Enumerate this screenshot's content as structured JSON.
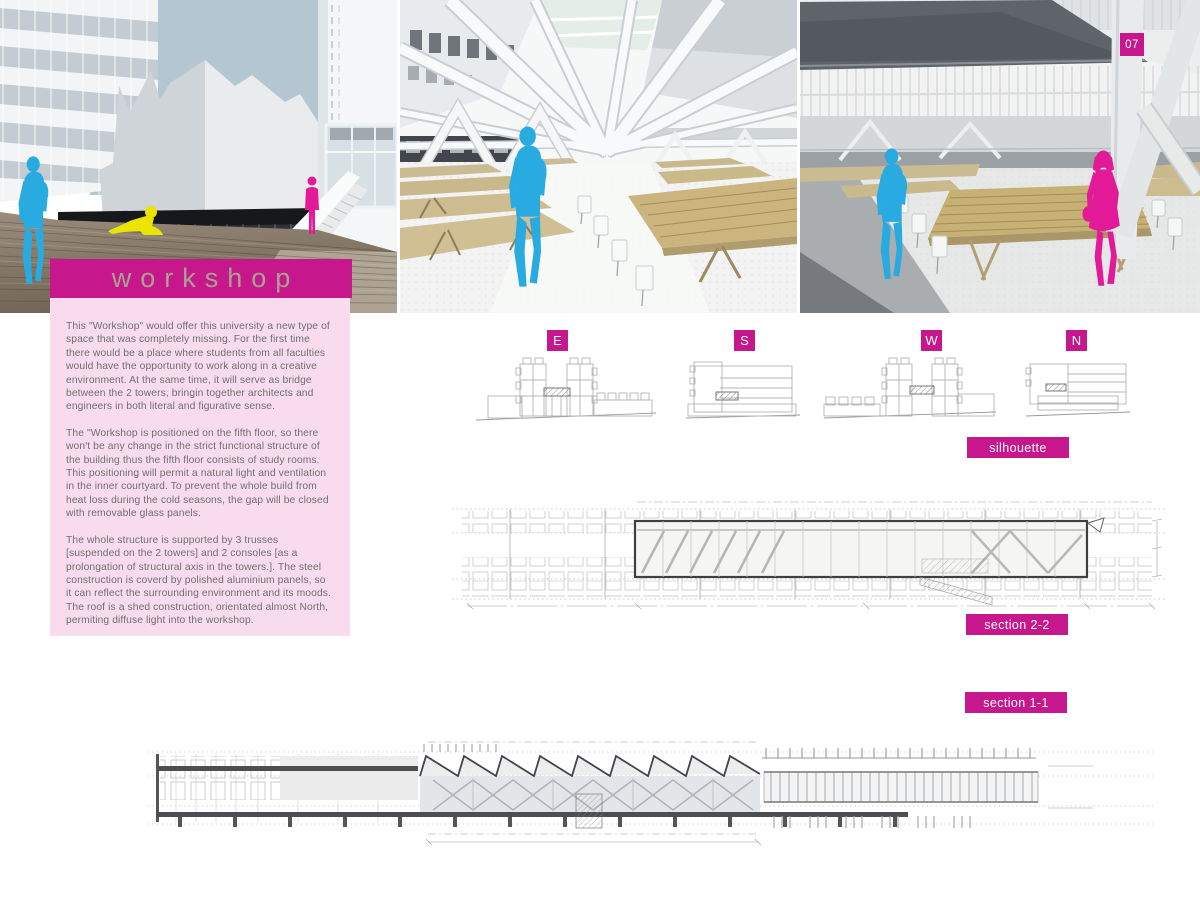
{
  "page": {
    "number": "07"
  },
  "title": {
    "label": "workshop"
  },
  "description": {
    "paragraphs": [
      "This \"Workshop\" would offer this university a new type of space that was completely missing. For the first time there would be a place where students from all faculties would have the opportunity to work along in a creative environment. At the same time, it will serve as bridge between the 2 towers, bringin together architects and engineers in both literal and figurative sense.",
      "The \"Workshop is positioned on the fifth floor, so there won't be any change in the strict functional structure of the building thus the fifth floor consists of study rooms. This positioning will permit a natural light and ventilation in the inner courtyard. To prevent the whole build from heat loss during the cold seasons, the gap will be closed with removable glass panels.",
      "The whole structure is supported by 3 trusses [suspended on the 2 towers] and 2 consoles [as a prolongation of structural axis in the towers.]. The steel construction is coverd by polished aluminium panels, so it can reflect the surrounding environment and its moods. The roof is a shed construction, orientated almost North, permiting diffuse light into the workshop."
    ]
  },
  "elevations": {
    "items": [
      {
        "label": "E"
      },
      {
        "label": "S"
      },
      {
        "label": "W"
      },
      {
        "label": "N"
      }
    ],
    "caption": "silhouette"
  },
  "sections": {
    "section_2_2": {
      "label": "section 2-2"
    },
    "section_1_1": {
      "label": "section 1-1"
    }
  },
  "colors": {
    "accent_magenta": "#c6188c",
    "panel_pink": "#f8dcee",
    "figure_cyan": "#29abe2",
    "figure_magenta": "#e21a98",
    "figure_yellow": "#ebe300",
    "body_text": "#6f6f6f",
    "drawing_line_light": "#b6b6b6",
    "drawing_line_dark": "#4b4e52"
  }
}
